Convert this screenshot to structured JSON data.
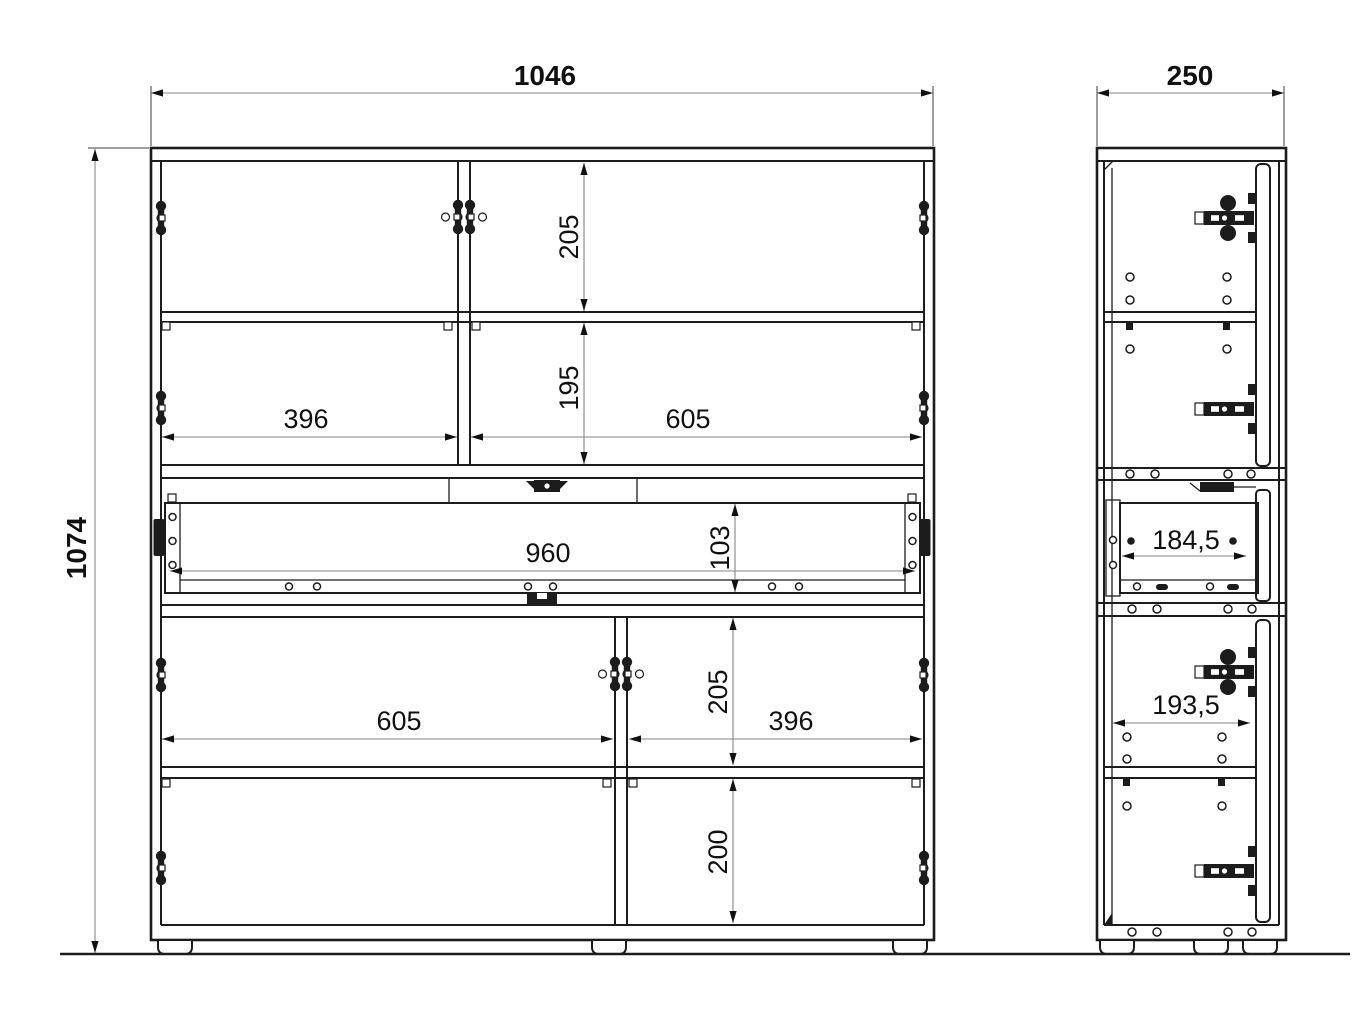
{
  "dimensions": {
    "front": {
      "overall_width": "1046",
      "overall_height": "1074",
      "top_door_height": "205",
      "upper_shelf_height": "195",
      "upper_left_width": "396",
      "upper_right_width": "605",
      "drawer_width": "960",
      "drawer_front_height": "103",
      "lower_left_width": "605",
      "lower_right_width": "396",
      "lower_door_height": "205",
      "bottom_shelf_height": "200"
    },
    "side": {
      "overall_depth": "250",
      "drawer_inner_depth": "184,5",
      "door_inner_depth": "193,5"
    }
  }
}
